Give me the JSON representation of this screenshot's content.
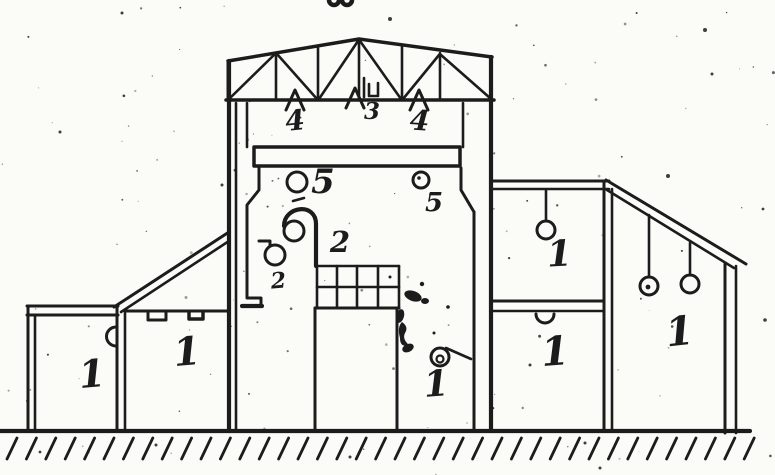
{
  "figure": {
    "description": "Scanned hand-drawn cross-section of an industrial building marking numbered luminaire positions",
    "top_cropped_mark": "oo",
    "colors": {
      "ink": "#1c1c1c",
      "paper": "#fbfbf8"
    },
    "labels": {
      "truss_skylight_left": "4",
      "truss_ridge": "3",
      "truss_skylight_right": "4",
      "crane_level_left": "5",
      "crane_level_right": "5",
      "hook_zone_left": "2",
      "hook_zone_right": "2",
      "bay_floor_lamp": "1",
      "left_annex_outer_room": "1",
      "left_annex_inner_room": "1",
      "right_annex_upper_room": "1",
      "right_annex_lower_room": "1",
      "right_tall_section": "1"
    }
  }
}
